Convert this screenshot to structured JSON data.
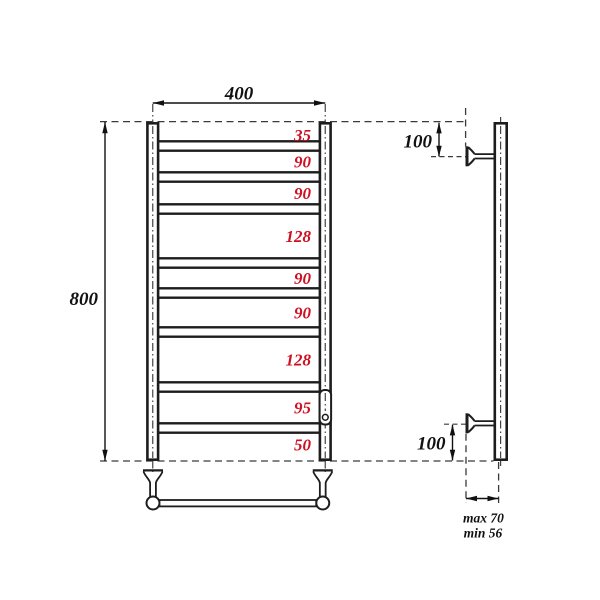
{
  "colors": {
    "accent": "#cc1122",
    "line": "#1d1d1d"
  },
  "front_view": {
    "width_label": "400",
    "height_label": "800",
    "segment_labels": [
      "35",
      "90",
      "90",
      "128",
      "90",
      "90",
      "128",
      "95",
      "50"
    ]
  },
  "side_view": {
    "top_offset_label": "100",
    "bottom_offset_label": "100",
    "depth_max_label": "max 70",
    "depth_min_label": "min 56"
  }
}
